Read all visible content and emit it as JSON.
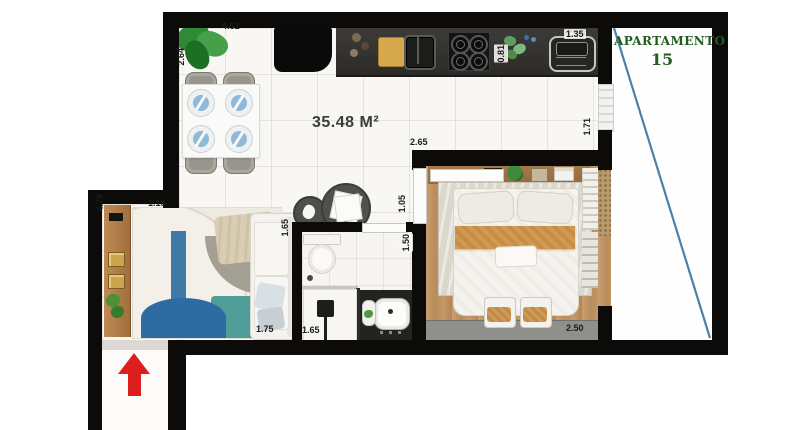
{
  "plan": {
    "title": "APARTAMENTO",
    "unit_number": "15",
    "area_label": "35.48 M²",
    "dimensions": {
      "dining_top": "4.61",
      "dining_left": "2.64",
      "kitchen_sink_width": "1.35",
      "kitchen_counter_depth": "0.81",
      "bedroom_hall_top": "2.65",
      "bedroom_right_side": "1.71",
      "hallway_width": "1.05",
      "living_top": "1.15",
      "living_left_side": "4.78",
      "sofa_right_side": "1.65",
      "sofa_bottom": "1.75",
      "shower_width": "1.65",
      "bathroom_door": "1.50",
      "bedroom_bottom": "2.50"
    },
    "colors": {
      "wall": "#0c0b0a",
      "wood_floor": "#bf925f",
      "kitchen_counter": "#35342f",
      "title_green": "#235c21",
      "boundary_line_blue": "#4b81a8",
      "entry_arrow_red": "#dd1e1e",
      "rug_blue": "#2e6ba3",
      "rug_teal": "#4f9d98",
      "bed_throw_orange": "#d09a52",
      "plate_blue": "#8fb9d8"
    }
  }
}
